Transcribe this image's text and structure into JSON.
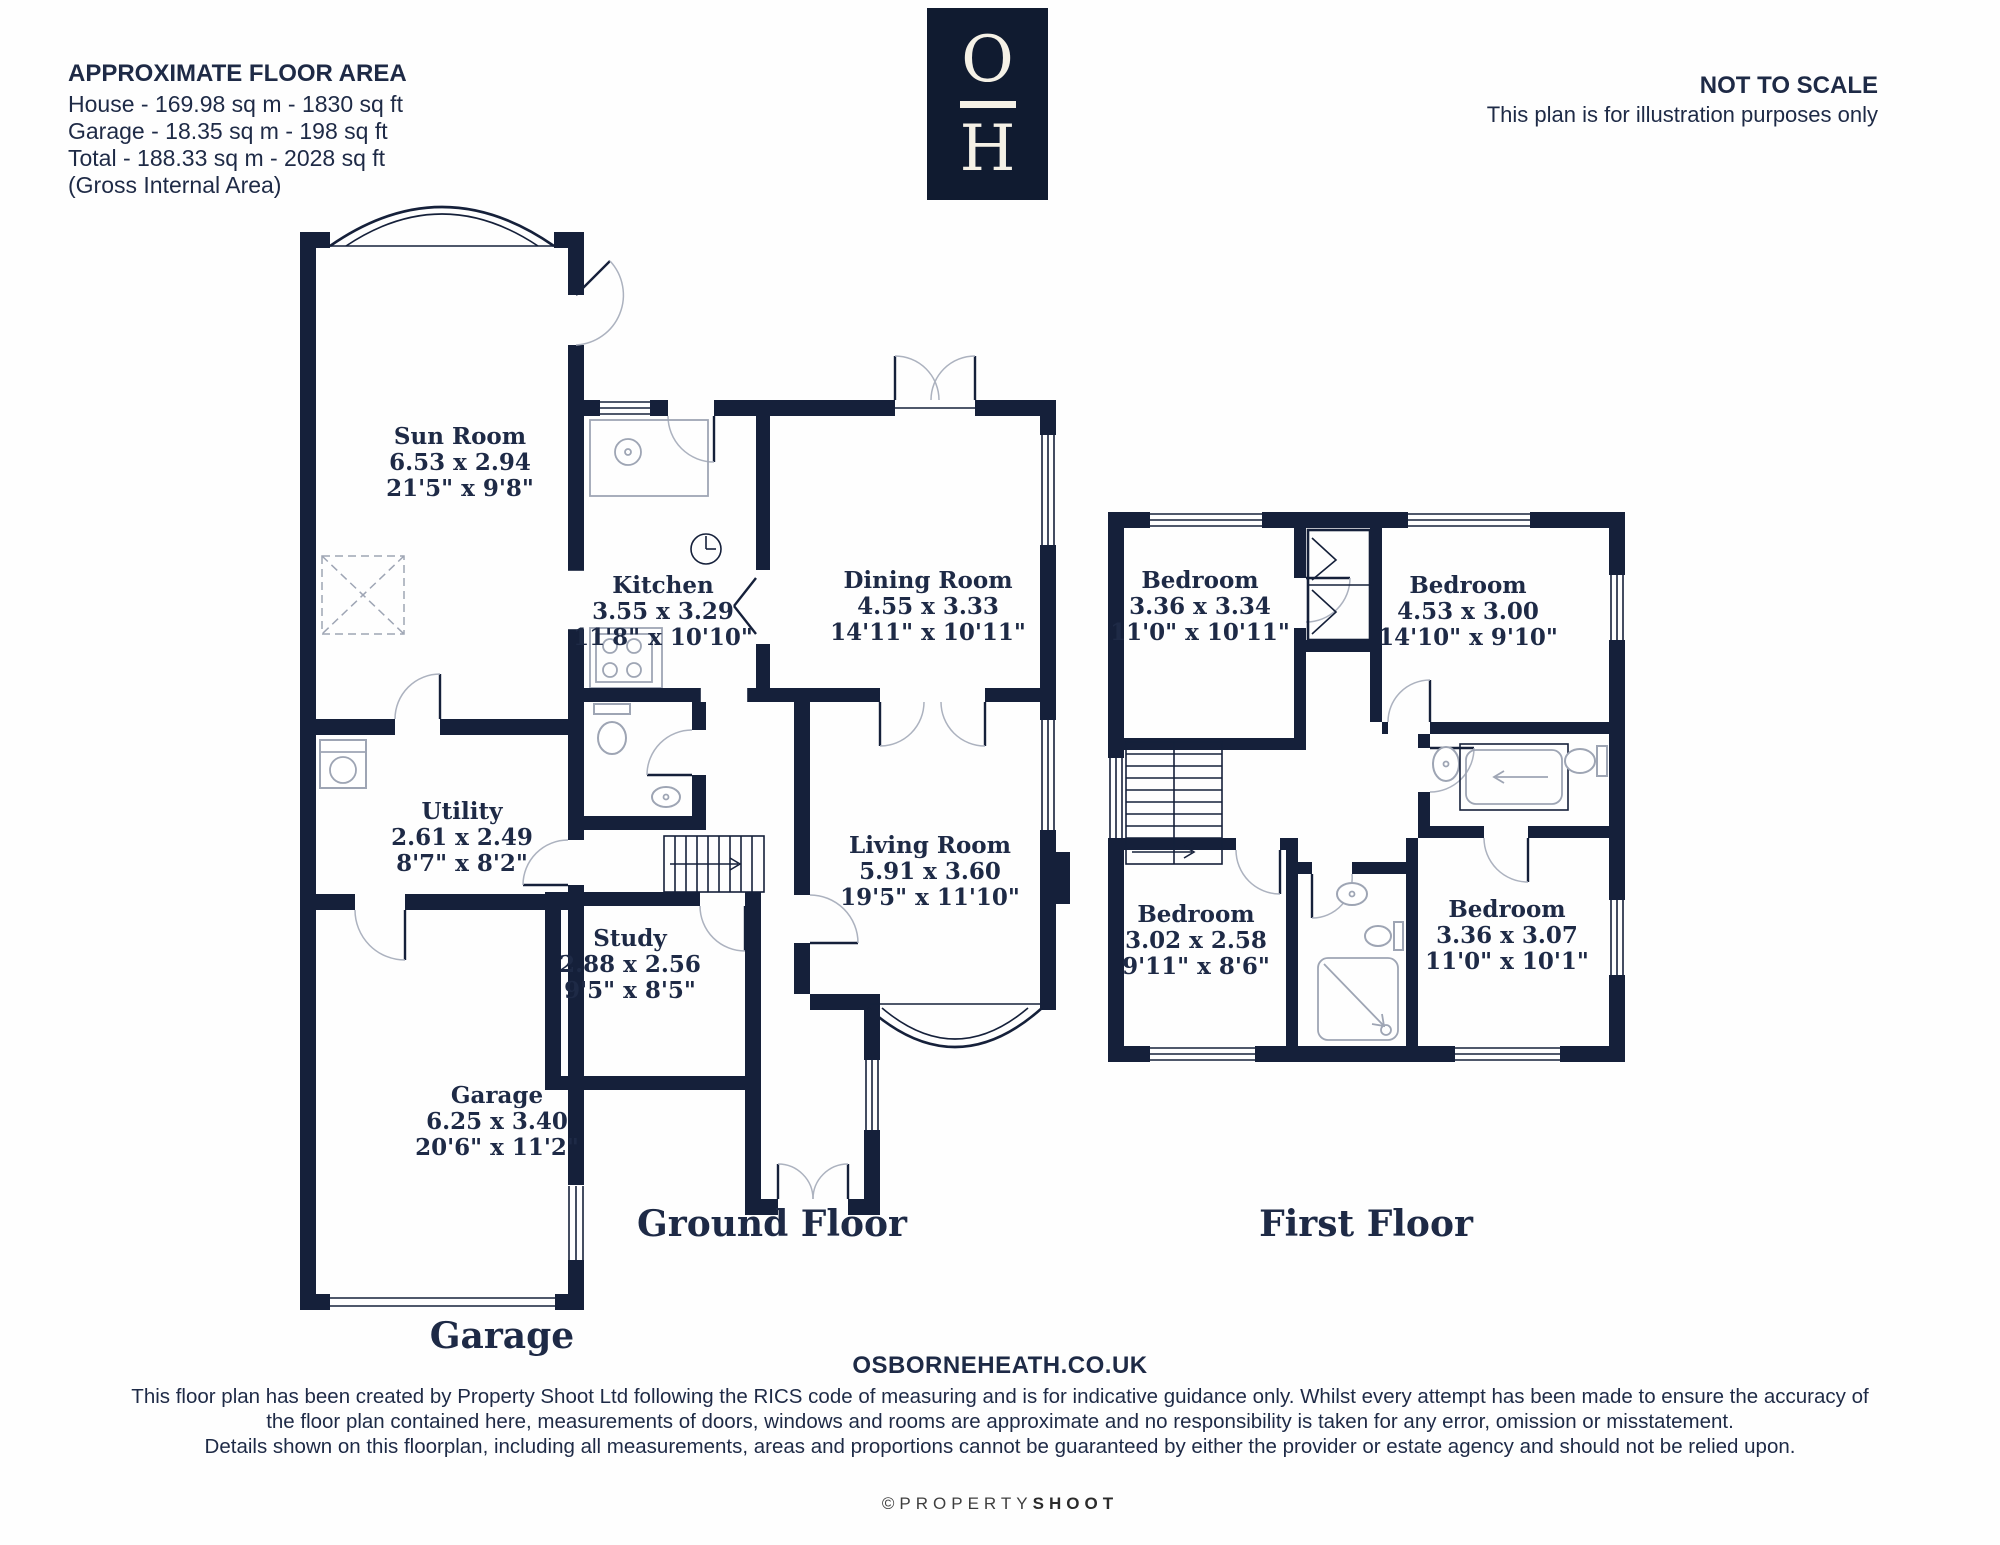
{
  "header": {
    "floor_area": {
      "title": "APPROXIMATE FLOOR AREA",
      "lines": [
        "House - 169.98 sq m - 1830 sq ft",
        "Garage - 18.35 sq m - 198 sq ft",
        "Total - 188.33 sq m - 2028 sq ft",
        "(Gross Internal Area)"
      ]
    },
    "logo": {
      "letter_top": "O",
      "letter_bottom": "H"
    },
    "scale_notice": {
      "title": "NOT TO SCALE",
      "subtitle": "This plan is for illustration purposes only"
    }
  },
  "ground_floor": {
    "title": "Ground Floor",
    "annex_title": "Garage",
    "rooms": [
      {
        "name": "Sun Room",
        "metric": "6.53 x 2.94",
        "imperial": "21'5\" x 9'8\""
      },
      {
        "name": "Kitchen",
        "metric": "3.55 x 3.29",
        "imperial": "11'8\" x 10'10\""
      },
      {
        "name": "Dining Room",
        "metric": "4.55 x 3.33",
        "imperial": "14'11\" x 10'11\""
      },
      {
        "name": "Utility",
        "metric": "2.61 x 2.49",
        "imperial": "8'7\" x 8'2\""
      },
      {
        "name": "Living Room",
        "metric": "5.91 x 3.60",
        "imperial": "19'5\" x 11'10\""
      },
      {
        "name": "Study",
        "metric": "2.88 x 2.56",
        "imperial": "9'5\" x 8'5\""
      },
      {
        "name": "Garage",
        "metric": "6.25 x 3.40",
        "imperial": "20'6\" x 11'2\""
      }
    ]
  },
  "first_floor": {
    "title": "First Floor",
    "rooms": [
      {
        "name": "Bedroom",
        "metric": "3.36 x 3.34",
        "imperial": "11'0\" x 10'11\""
      },
      {
        "name": "Bedroom",
        "metric": "4.53 x 3.00",
        "imperial": "14'10\" x 9'10\""
      },
      {
        "name": "Bedroom",
        "metric": "3.02 x 2.58",
        "imperial": "9'11\" x 8'6\""
      },
      {
        "name": "Bedroom",
        "metric": "3.36 x 3.07",
        "imperial": "11'0\" x 10'1\""
      }
    ]
  },
  "footer": {
    "website": "OSBORNEHEATH.CO.UK",
    "disclaimer": [
      "This floor plan has been created by Property Shoot Ltd following the RICS code of measuring and is for indicative guidance only. Whilst every attempt has been made to ensure the accuracy of",
      "the floor plan contained here, measurements of doors, windows and rooms are approximate and no responsibility is taken for any error, omission or misstatement.",
      "Details shown on this floorplan, including all measurements, areas and proportions cannot be guaranteed by either the provider or estate agency and should not be relied upon."
    ],
    "credit_prefix": "©PROPERTY",
    "credit_suffix": "SHOOT"
  },
  "colors": {
    "wall_navy": "#15203A",
    "text_navy": "#1E2A46",
    "logo_bg": "#101B30",
    "logo_cream": "#F5F1E6"
  }
}
